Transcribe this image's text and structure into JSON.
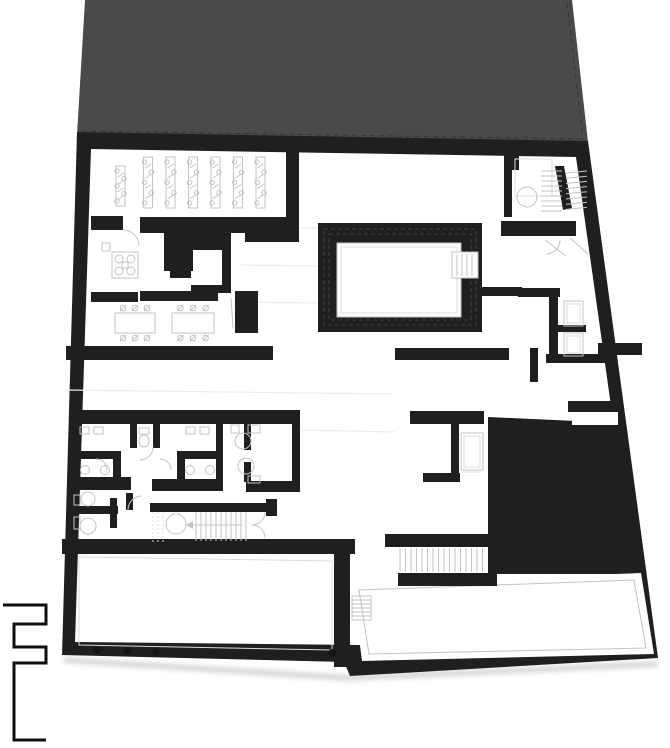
{
  "canvas": {
    "width": 670,
    "height": 748
  },
  "colors": {
    "background": "#ffffff",
    "floor_fill": "#ffffff",
    "roof_fill": "#4a4a4a",
    "roof_dash": "#353535",
    "wall_fill": "#1f1f1f",
    "wall_inner": "#2b2b2b",
    "pool_dash": "#424242",
    "fixture_line": "#c3c3c3",
    "fixture_light": "#dcdcdc",
    "floor_line": "#ececec",
    "column_fill": "#141414",
    "marker_stroke": "#0f0f0f",
    "shadow": "#a8a8a8"
  },
  "features": [
    "roof-mass",
    "refectory-hall-with-tables",
    "kitchen-with-stove",
    "dining-tables-room",
    "swimming-pool",
    "pool-entry-steps",
    "upper-right-staircase",
    "central-staircase",
    "corridor",
    "changing-rooms-and-toilets",
    "accessible-wc",
    "showers",
    "elevator",
    "service-dark-mass",
    "multipurpose-hall-with-columns",
    "lower-staircase-to-terrace",
    "terrace-access-stair",
    "terrace",
    "structural-columns",
    "site-boundary-step-marker"
  ]
}
